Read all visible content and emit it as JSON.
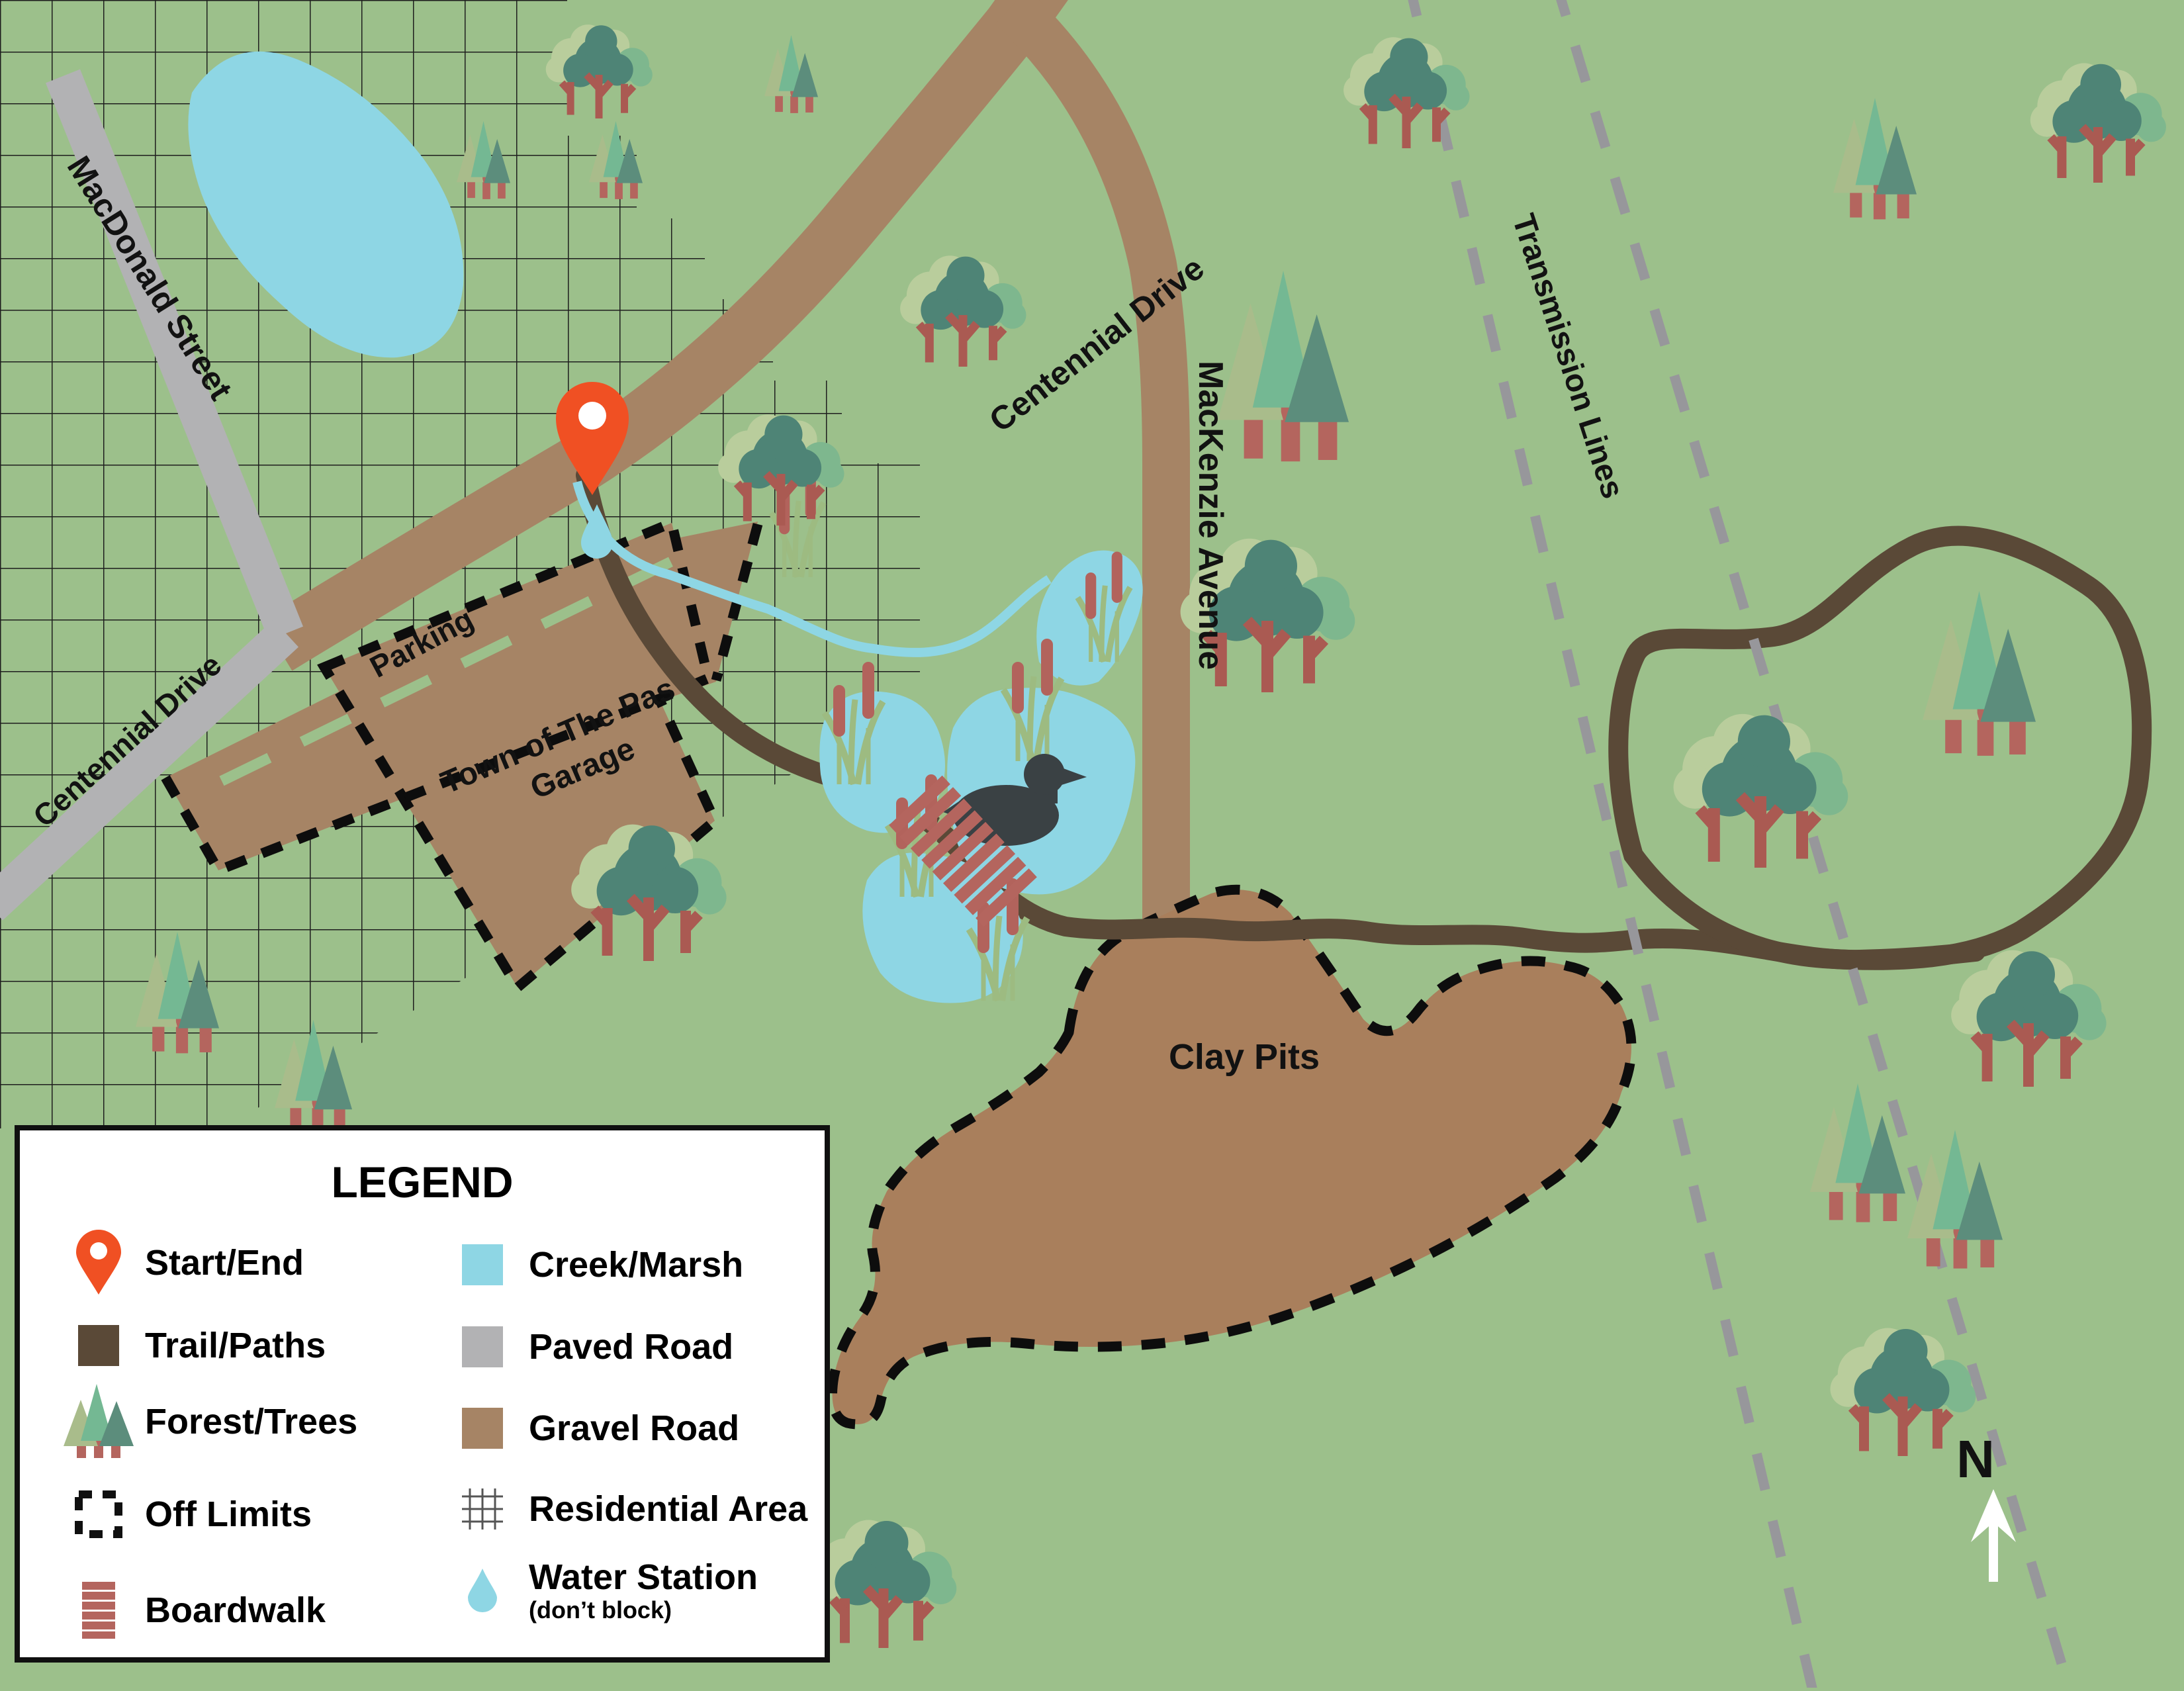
{
  "map": {
    "labels": {
      "macdonald_street": "MacDonald Street",
      "centennial_drive_paved": "Centennial Drive",
      "centennial_drive_gravel": "Centennial Drive",
      "mackenzie_avenue": "MacKenzie Avenue",
      "transmission_lines": "Transmission Lines",
      "clay_pits": "Clay Pits",
      "parking": "Parking",
      "garage_line1": "Town of The Pas",
      "garage_line2": "Garage",
      "north": "N"
    },
    "colors": {
      "grass": "#9cc08b",
      "water": "#8ed6e4",
      "paved_road": "#b2b2b4",
      "gravel_road": "#a68465",
      "clay_pits": "#a97f5c",
      "trail": "#5a4937",
      "transmission": "#97979b",
      "pin": "#f05023",
      "boardwalk": "#b4655e"
    }
  },
  "legend": {
    "title": "LEGEND",
    "items_left": [
      {
        "icon": "start-end-pin-icon",
        "label": "Start/End"
      },
      {
        "icon": "trail-swatch-icon",
        "label": "Trail/Paths"
      },
      {
        "icon": "forest-trees-icon",
        "label": "Forest/Trees"
      },
      {
        "icon": "off-limits-icon",
        "label": "Off Limits"
      },
      {
        "icon": "boardwalk-icon",
        "label": "Boardwalk"
      }
    ],
    "items_right": [
      {
        "icon": "creek-marsh-swatch-icon",
        "label": "Creek/Marsh"
      },
      {
        "icon": "paved-road-swatch-icon",
        "label": "Paved Road"
      },
      {
        "icon": "gravel-road-swatch-icon",
        "label": "Gravel Road"
      },
      {
        "icon": "residential-area-icon",
        "label": "Residential Area"
      },
      {
        "icon": "water-station-icon",
        "label": "Water Station",
        "sublabel": "(don’t block)"
      }
    ]
  }
}
